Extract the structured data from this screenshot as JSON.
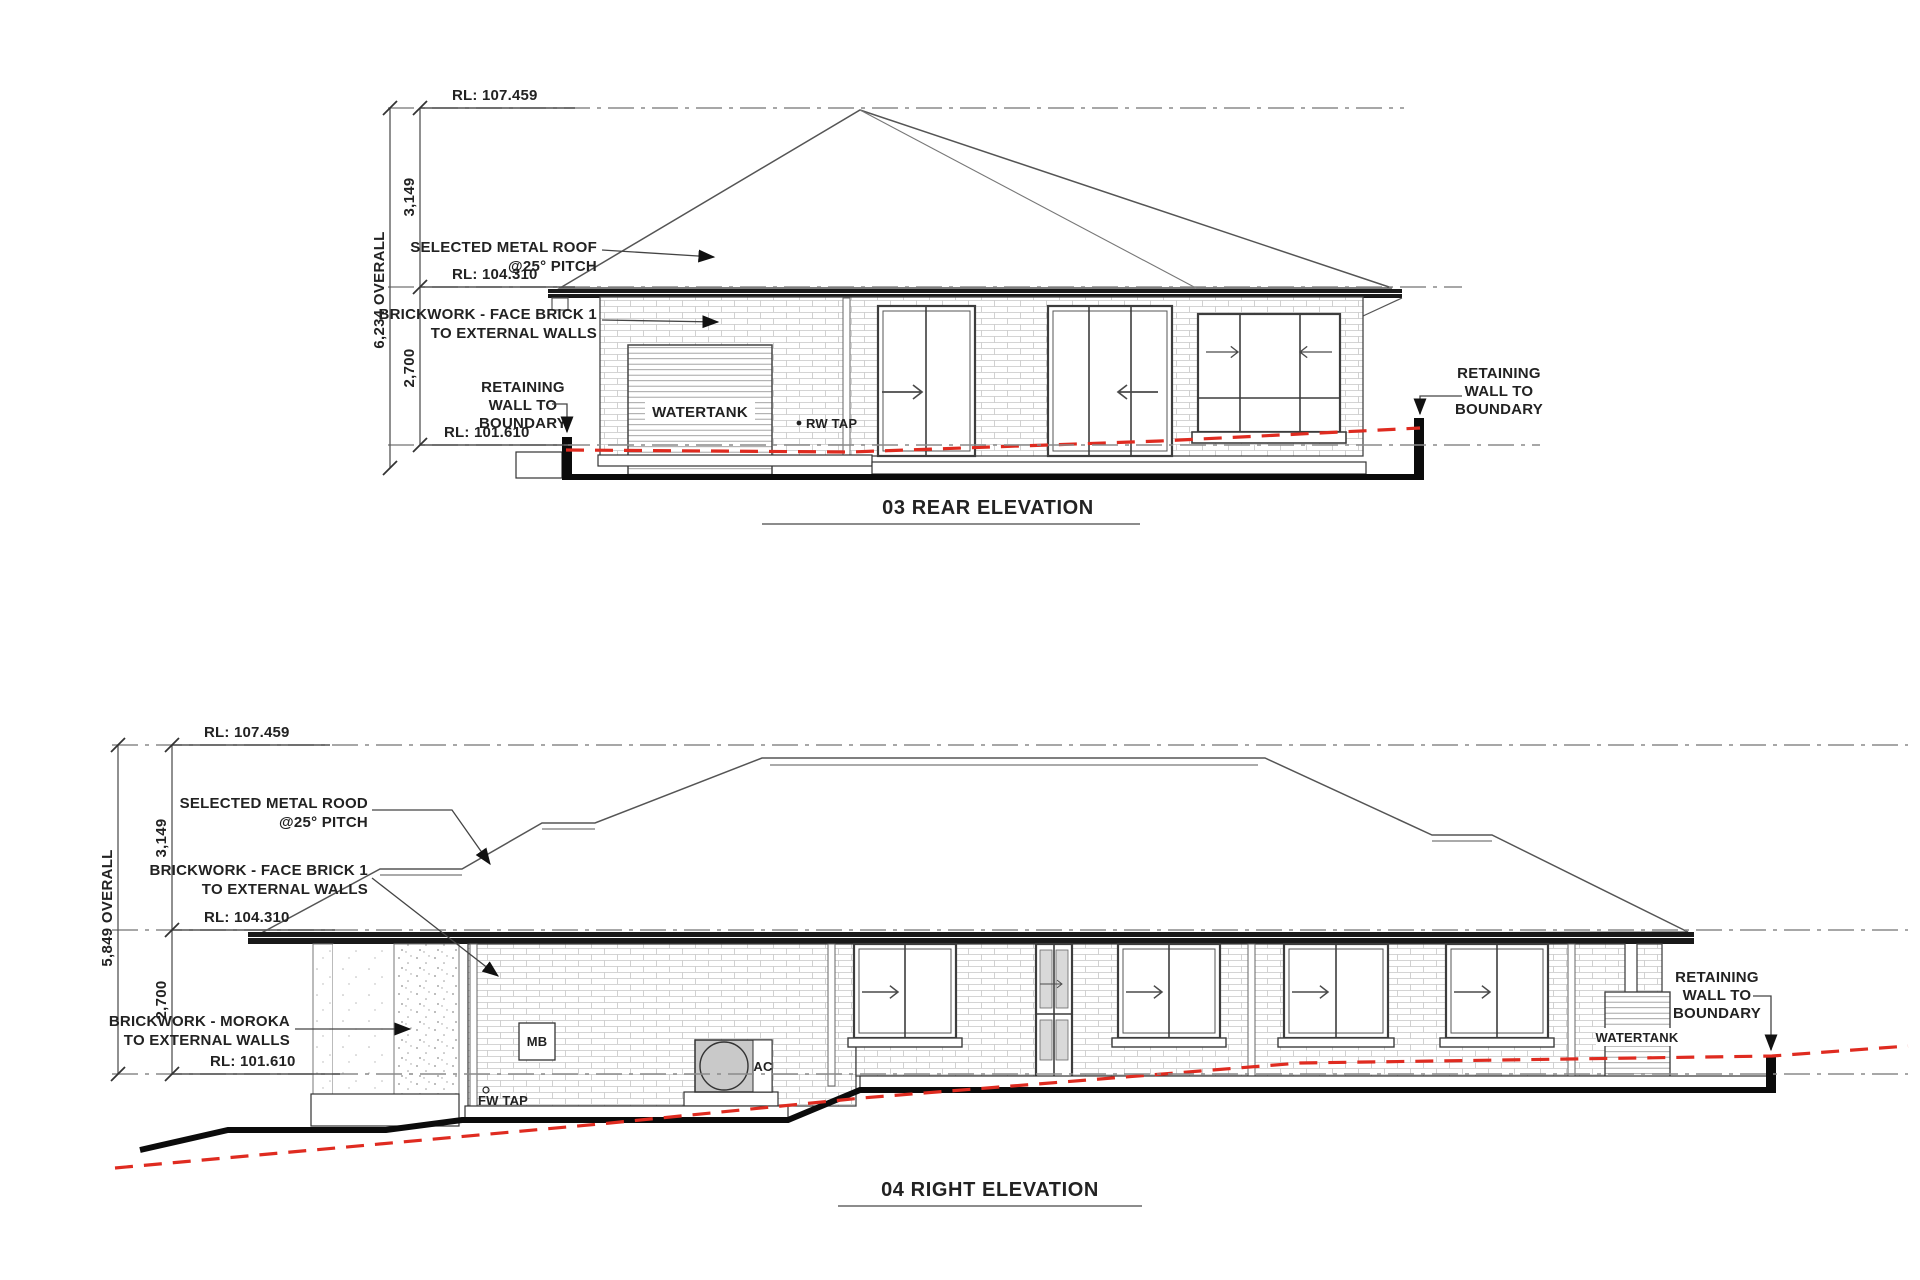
{
  "colors": {
    "ngl_red": "#df2b20",
    "fascia_dark": "#191919",
    "ground_black": "#0b0b0b",
    "glass_gray": "#d9d9d9",
    "ac_gray": "#c9c9c9"
  },
  "rear": {
    "title": "03 REAR ELEVATION",
    "rl_top": "RL: 107.459",
    "rl_mid": "RL: 104.310",
    "rl_bot": "RL: 101.610",
    "dim_upper": "3,149",
    "dim_overall": "6,234 OVERALL",
    "dim_lower": "2,700",
    "roof_label_1": "SELECTED METAL ROOF",
    "roof_label_2": "@25° PITCH",
    "brick_label_1": "BRICKWORK - FACE BRICK 1",
    "brick_label_2": "TO EXTERNAL WALLS",
    "ret_left_1": "RETAINING",
    "ret_left_2": "WALL TO",
    "ret_left_3": "BOUNDARY",
    "ret_right_1": "RETAINING",
    "ret_right_2": "WALL TO",
    "ret_right_3": "BOUNDARY",
    "watertank": "WATERTANK",
    "rw_tap": "RW TAP"
  },
  "right": {
    "title": "04 RIGHT ELEVATION",
    "rl_top": "RL: 107.459",
    "rl_mid": "RL: 104.310",
    "rl_bot": "RL: 101.610",
    "dim_upper": "3,149",
    "dim_overall": "5,849 OVERALL",
    "dim_lower": "2,700",
    "roof_label_1": "SELECTED METAL ROOD",
    "roof_label_2": "@25° PITCH",
    "brick_label_1": "BRICKWORK - FACE BRICK 1",
    "brick_label_2": "TO EXTERNAL WALLS",
    "moroka_label_1": "BRICKWORK - MOROKA",
    "moroka_label_2": "TO EXTERNAL WALLS",
    "ret_1": "RETAINING",
    "ret_2": "WALL TO",
    "ret_3": "BOUNDARY",
    "watertank": "WATERTANK",
    "mb": "MB",
    "ac": "AC",
    "fw_tap": "FW TAP"
  }
}
